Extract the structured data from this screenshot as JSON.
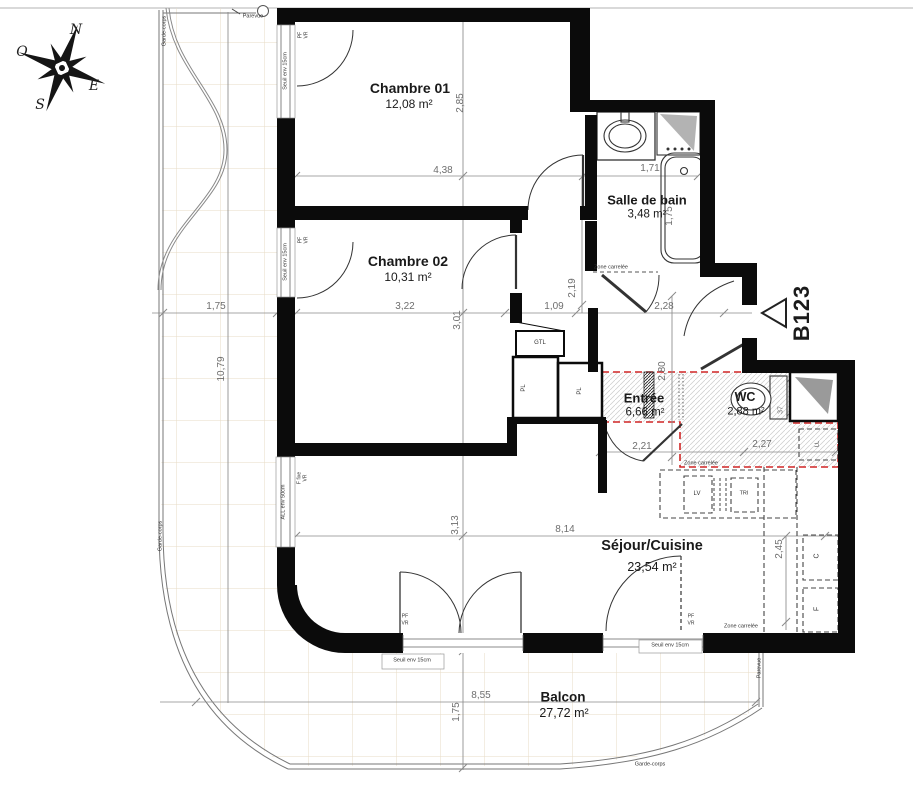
{
  "title_block": {
    "unit": "B123"
  },
  "compass": {
    "north": "N",
    "east": "E",
    "south": "S",
    "west": "O"
  },
  "rooms": [
    {
      "name": "Chambre 01",
      "area": "12,08 m²"
    },
    {
      "name": "Chambre 02",
      "area": "10,31 m²"
    },
    {
      "name": "Salle de bain",
      "area": "3,48 m²"
    },
    {
      "name": "Entrée",
      "area": "6,66 m²"
    },
    {
      "name": "WC",
      "area": "2,88 m²"
    },
    {
      "name": "Séjour/Cuisine",
      "area": "23,54 m²"
    },
    {
      "name": "Balcon",
      "area": "27,72 m²"
    }
  ],
  "dimensions": {
    "ch01_width": "4,38",
    "ch01_height": "2,85",
    "sdb_width": "1,71",
    "tub_height": "1,75",
    "ch02_width": "3,22",
    "ch02_height": "3,01",
    "hall_width": "1,09",
    "hall_depth": "2,28",
    "hall_height": "2,19",
    "entree_height": "2,80",
    "entree_width": "2,21",
    "wc_width": "2,27",
    "wc_small": "37",
    "sejour_width": "8,14",
    "sejour_height": "3,13",
    "kitchen_height": "2,45",
    "balcon_width": "8,55",
    "balcon_height": "1,75",
    "balcon_left_width": "1,75",
    "balcon_left_height": "10,79"
  },
  "annotations": {
    "seuil": "Seuil env 15cm",
    "allege": "ALL env 50cm",
    "pf": "PF",
    "vr": "VR",
    "f_fixe": "F fixe",
    "zone_carrelee": "Zone carrelée",
    "garde_corps": "Garde-corps",
    "parevue": "Parevue",
    "gtl": "GTL",
    "pl": "PL",
    "lv": "LV",
    "tri": "TRI",
    "cooker": "C",
    "fridge": "F",
    "ll": "LL"
  },
  "colors": {
    "wall": "#0b0b0b",
    "zone_carrelee_border": "#d02525",
    "tile_line": "#e7dbc6",
    "dimension_line": "#8a8a8a"
  }
}
